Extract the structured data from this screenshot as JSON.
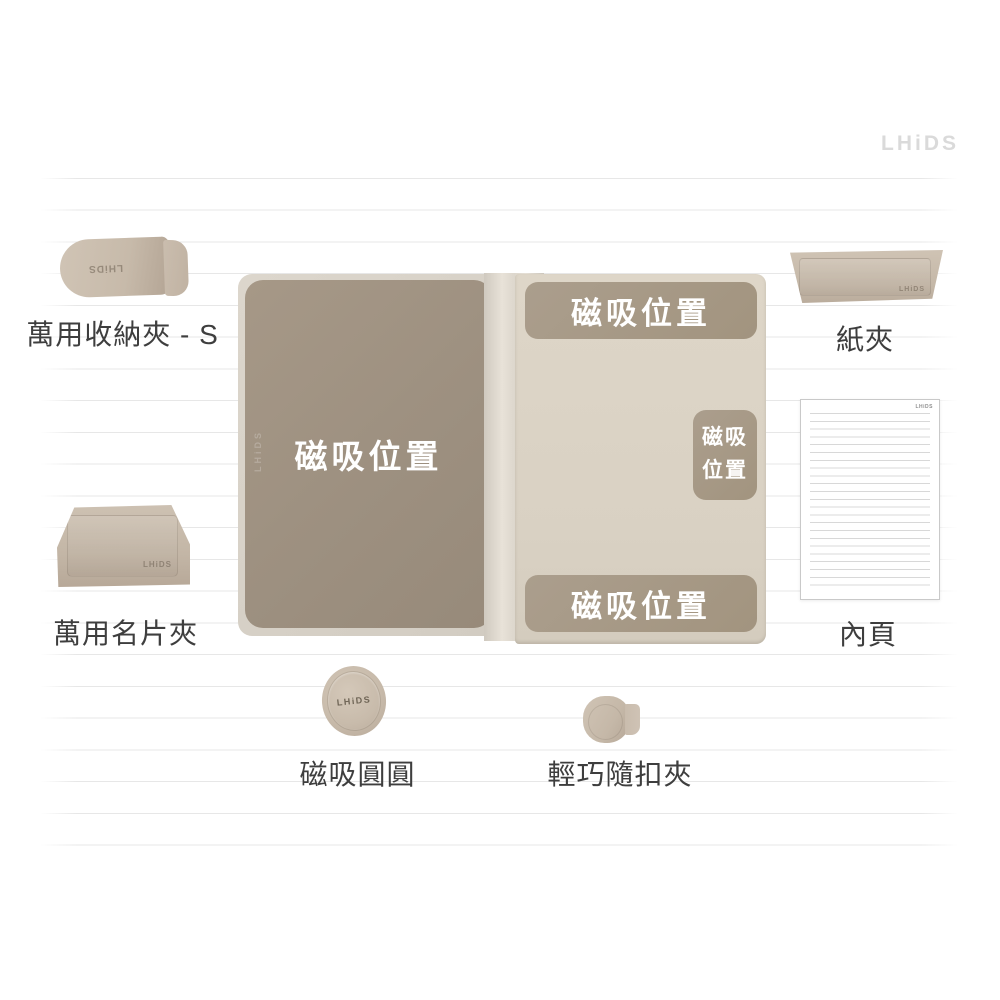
{
  "brand": {
    "logo_text": "LHiDS"
  },
  "notebook": {
    "left_page_magnet_label": "磁吸位置",
    "top_magnet_label": "磁吸位置",
    "side_magnet_label_line1": "磁吸",
    "side_magnet_label_line2": "位置",
    "bottom_magnet_label": "磁吸位置",
    "spine_emboss_text": "LHiDS"
  },
  "products": {
    "storage_clip_s": {
      "label": "萬用收納夾 - S",
      "emboss_text": "LHiDS"
    },
    "paper_clip": {
      "label": "紙夾",
      "emboss_text": "LHiDS"
    },
    "inner_page": {
      "label": "內頁",
      "corner_brand_text": "LHiDS"
    },
    "card_holder": {
      "label": "萬用名片夾",
      "emboss_text": "LHiDS"
    },
    "magnet_disc": {
      "label": "磁吸圓圓",
      "center_brand_text": "LHiDS"
    },
    "buckle_clip": {
      "label": "輕巧隨扣夾"
    }
  },
  "colors": {
    "background": "#ffffff",
    "ruled_line": "#e7e7e7",
    "cover_beige": "#d7d1c7",
    "left_page_taupe": "#9d9080",
    "right_page_beige": "#dcd4c5",
    "magnet_zone_taupe": "#a79a89",
    "product_beige": "#c8bbac",
    "label_text": "#3e3e3e",
    "magnet_label_text": "#ffffff",
    "logo_gray": "#dadada"
  }
}
